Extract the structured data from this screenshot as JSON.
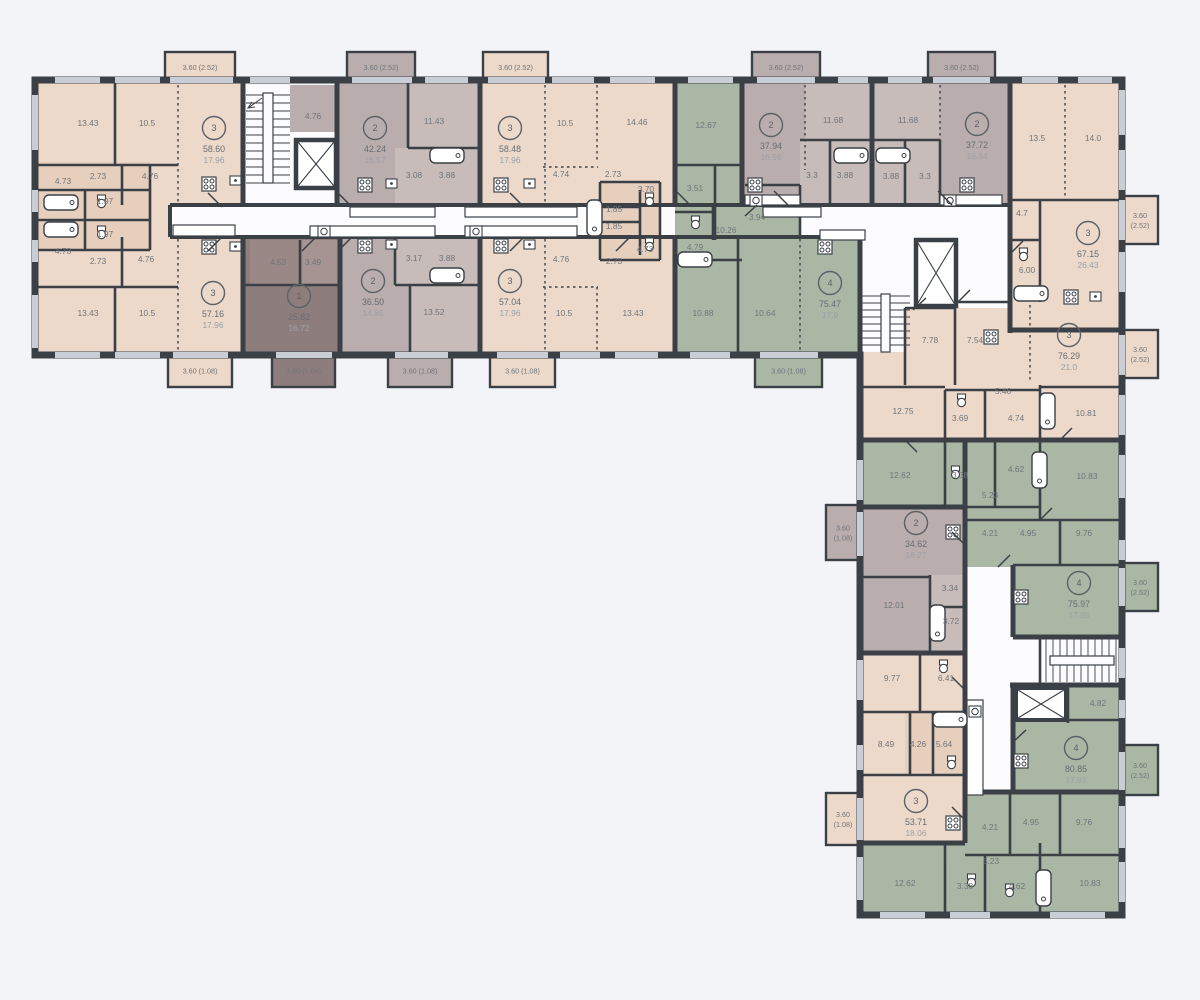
{
  "colors": {
    "wall": "#3B4046",
    "background": "#F3F4F8",
    "corridor": "#FCFCFE",
    "window": "#C9CED6",
    "beige": "#ECD9CA",
    "beige_dark": "#E7CFBE",
    "gray": "#B9ADAD",
    "gray_light": "#C7BCBA",
    "brown": "#8E7D7D",
    "brown_mid": "#9A8886",
    "brown_light": "#A69492",
    "green": "#AAB7A4",
    "text": "#70757C",
    "badge": "#5C6167"
  },
  "apartments": [
    {
      "number": "3",
      "total": "58.60",
      "living": "17.96",
      "cx": 214,
      "cy": 128
    },
    {
      "number": "2",
      "total": "42.24",
      "living": "16.57",
      "cx": 375,
      "cy": 128
    },
    {
      "number": "3",
      "total": "58.48",
      "living": "17.96",
      "cx": 510,
      "cy": 128
    },
    {
      "number": "2",
      "total": "37.94",
      "living": "16.56",
      "cx": 771,
      "cy": 125
    },
    {
      "number": "2",
      "total": "37.72",
      "living": "16.34",
      "cx": 977,
      "cy": 124
    },
    {
      "number": "3",
      "total": "67.15",
      "living": "26.43",
      "cx": 1088,
      "cy": 233
    },
    {
      "number": "4",
      "total": "75.47",
      "living": "17.9",
      "cx": 830,
      "cy": 283
    },
    {
      "number": "3",
      "total": "57.16",
      "living": "17.96",
      "cx": 213,
      "cy": 293
    },
    {
      "number": "1",
      "total": "25.82",
      "living": "16.72",
      "cx": 299,
      "cy": 296
    },
    {
      "number": "2",
      "total": "36.50",
      "living": "14.85",
      "cx": 373,
      "cy": 281
    },
    {
      "number": "3",
      "total": "57.04",
      "living": "17.96",
      "cx": 510,
      "cy": 281
    },
    {
      "number": "3",
      "total": "76.29",
      "living": "21.0",
      "cx": 1069,
      "cy": 335
    },
    {
      "number": "2",
      "total": "34.62",
      "living": "16.27",
      "cx": 916,
      "cy": 523
    },
    {
      "number": "4",
      "total": "75.97",
      "living": "17.85",
      "cx": 1079,
      "cy": 583
    },
    {
      "number": "3",
      "total": "53.71",
      "living": "18.06",
      "cx": 916,
      "cy": 801
    },
    {
      "number": "4",
      "total": "80.85",
      "living": "17.91",
      "cx": 1076,
      "cy": 748
    }
  ],
  "room_labels": [
    {
      "t": "13.43",
      "x": 88,
      "y": 126
    },
    {
      "t": "10.5",
      "x": 147,
      "y": 126
    },
    {
      "t": "2.73",
      "x": 98,
      "y": 179
    },
    {
      "t": "4.76",
      "x": 150,
      "y": 179
    },
    {
      "t": "4.73",
      "x": 63,
      "y": 184
    },
    {
      "t": "1.97",
      "x": 105,
      "y": 204
    },
    {
      "t": "1.97",
      "x": 105,
      "y": 237
    },
    {
      "t": "4.73",
      "x": 63,
      "y": 254
    },
    {
      "t": "2.73",
      "x": 98,
      "y": 264
    },
    {
      "t": "4.76",
      "x": 146,
      "y": 262
    },
    {
      "t": "13.43",
      "x": 88,
      "y": 316
    },
    {
      "t": "10.5",
      "x": 147,
      "y": 316
    },
    {
      "t": "4.76",
      "x": 313,
      "y": 119
    },
    {
      "t": "11.43",
      "x": 434,
      "y": 124
    },
    {
      "t": "3.08",
      "x": 414,
      "y": 178
    },
    {
      "t": "3.88",
      "x": 447,
      "y": 178
    },
    {
      "t": "10.5",
      "x": 565,
      "y": 126
    },
    {
      "t": "14.46",
      "x": 637,
      "y": 125
    },
    {
      "t": "4.74",
      "x": 561,
      "y": 177
    },
    {
      "t": "2.73",
      "x": 613,
      "y": 177
    },
    {
      "t": "3.70",
      "x": 646,
      "y": 192
    },
    {
      "t": "1.85",
      "x": 614,
      "y": 212
    },
    {
      "t": "1.85",
      "x": 614,
      "y": 229
    },
    {
      "t": "4.73",
      "x": 645,
      "y": 252
    },
    {
      "t": "2.73",
      "x": 614,
      "y": 264
    },
    {
      "t": "4.53",
      "x": 278,
      "y": 265
    },
    {
      "t": "3.49",
      "x": 313,
      "y": 265
    },
    {
      "t": "3.17",
      "x": 414,
      "y": 261
    },
    {
      "t": "3.88",
      "x": 447,
      "y": 261
    },
    {
      "t": "13.52",
      "x": 434,
      "y": 315
    },
    {
      "t": "4.76",
      "x": 561,
      "y": 262
    },
    {
      "t": "10.5",
      "x": 564,
      "y": 316
    },
    {
      "t": "13.43",
      "x": 633,
      "y": 316
    },
    {
      "t": "12.67",
      "x": 706,
      "y": 128
    },
    {
      "t": "3.51",
      "x": 695,
      "y": 191
    },
    {
      "t": "10.26",
      "x": 726,
      "y": 233
    },
    {
      "t": "4.79",
      "x": 695,
      "y": 250
    },
    {
      "t": "3.94",
      "x": 757,
      "y": 220
    },
    {
      "t": "10.88",
      "x": 703,
      "y": 316
    },
    {
      "t": "10.64",
      "x": 765,
      "y": 316
    },
    {
      "t": "11.68",
      "x": 833,
      "y": 123
    },
    {
      "t": "3.3",
      "x": 812,
      "y": 178
    },
    {
      "t": "3.88",
      "x": 845,
      "y": 178
    },
    {
      "t": "11.68",
      "x": 908,
      "y": 123
    },
    {
      "t": "3.88",
      "x": 891,
      "y": 179
    },
    {
      "t": "3.3",
      "x": 925,
      "y": 179
    },
    {
      "t": "13.5",
      "x": 1037,
      "y": 141
    },
    {
      "t": "14.0",
      "x": 1093,
      "y": 141
    },
    {
      "t": "4.7",
      "x": 1022,
      "y": 216
    },
    {
      "t": "6.00",
      "x": 1027,
      "y": 273
    },
    {
      "t": "7.78",
      "x": 930,
      "y": 343
    },
    {
      "t": "7.54",
      "x": 975,
      "y": 343
    },
    {
      "t": "5.46",
      "x": 1003,
      "y": 394
    },
    {
      "t": "12.75",
      "x": 903,
      "y": 414
    },
    {
      "t": "3.69",
      "x": 960,
      "y": 421
    },
    {
      "t": "4.74",
      "x": 1016,
      "y": 421
    },
    {
      "t": "10.81",
      "x": 1086,
      "y": 416
    },
    {
      "t": "12.62",
      "x": 900,
      "y": 478
    },
    {
      "t": "3.38",
      "x": 960,
      "y": 478
    },
    {
      "t": "4.62",
      "x": 1016,
      "y": 472
    },
    {
      "t": "10.83",
      "x": 1087,
      "y": 479
    },
    {
      "t": "5.23",
      "x": 990,
      "y": 498
    },
    {
      "t": "4.21",
      "x": 990,
      "y": 536
    },
    {
      "t": "4.95",
      "x": 1028,
      "y": 536
    },
    {
      "t": "9.76",
      "x": 1084,
      "y": 536
    },
    {
      "t": "3.34",
      "x": 950,
      "y": 591
    },
    {
      "t": "12.01",
      "x": 894,
      "y": 608
    },
    {
      "t": "3.72",
      "x": 951,
      "y": 624
    },
    {
      "t": "9.77",
      "x": 892,
      "y": 681
    },
    {
      "t": "6.41",
      "x": 946,
      "y": 681
    },
    {
      "t": "8.49",
      "x": 886,
      "y": 747
    },
    {
      "t": "4.26",
      "x": 918,
      "y": 747
    },
    {
      "t": "5.64",
      "x": 944,
      "y": 747
    },
    {
      "t": "4.82",
      "x": 1098,
      "y": 706
    },
    {
      "t": "4.21",
      "x": 990,
      "y": 830
    },
    {
      "t": "4.95",
      "x": 1031,
      "y": 825
    },
    {
      "t": "9.76",
      "x": 1084,
      "y": 825
    },
    {
      "t": "5.23",
      "x": 991,
      "y": 864
    },
    {
      "t": "12.62",
      "x": 905,
      "y": 886
    },
    {
      "t": "3.38",
      "x": 965,
      "y": 889
    },
    {
      "t": "4.62",
      "x": 1017,
      "y": 889
    },
    {
      "t": "10.83",
      "x": 1090,
      "y": 886
    }
  ],
  "balconies": [
    {
      "lines": [
        "3.60 (2.52)"
      ],
      "x": 165,
      "y": 52,
      "w": 70,
      "h": 31,
      "color": "beige"
    },
    {
      "lines": [
        "3.60 (2.52)"
      ],
      "x": 347,
      "y": 52,
      "w": 68,
      "h": 31,
      "color": "gray"
    },
    {
      "lines": [
        "3.60 (2.52)"
      ],
      "x": 483,
      "y": 52,
      "w": 65,
      "h": 31,
      "color": "beige"
    },
    {
      "lines": [
        "3.60 (2.52)"
      ],
      "x": 752,
      "y": 52,
      "w": 68,
      "h": 31,
      "color": "gray"
    },
    {
      "lines": [
        "3.60 (2.52)"
      ],
      "x": 928,
      "y": 52,
      "w": 67,
      "h": 31,
      "color": "gray"
    },
    {
      "lines": [
        "3.60 (1.08)"
      ],
      "x": 168,
      "y": 355,
      "w": 64,
      "h": 32,
      "color": "beige"
    },
    {
      "lines": [
        "3.60 (1.08)"
      ],
      "x": 272,
      "y": 355,
      "w": 63,
      "h": 32,
      "color": "brown"
    },
    {
      "lines": [
        "3.60 (1.08)"
      ],
      "x": 388,
      "y": 355,
      "w": 64,
      "h": 32,
      "color": "gray"
    },
    {
      "lines": [
        "3.60 (1.08)"
      ],
      "x": 490,
      "y": 355,
      "w": 65,
      "h": 32,
      "color": "beige"
    },
    {
      "lines": [
        "3.60 (1.08)"
      ],
      "x": 755,
      "y": 355,
      "w": 67,
      "h": 32,
      "color": "green"
    },
    {
      "lines": [
        "3.60",
        "(2.52)"
      ],
      "x": 1122,
      "y": 196,
      "w": 36,
      "h": 48,
      "color": "beige"
    },
    {
      "lines": [
        "3.60",
        "(2.52)"
      ],
      "x": 1122,
      "y": 330,
      "w": 36,
      "h": 48,
      "color": "beige"
    },
    {
      "lines": [
        "3.60",
        "(2.52)"
      ],
      "x": 1122,
      "y": 563,
      "w": 36,
      "h": 48,
      "color": "green"
    },
    {
      "lines": [
        "3.60",
        "(2.52)"
      ],
      "x": 1122,
      "y": 745,
      "w": 36,
      "h": 50,
      "color": "green"
    },
    {
      "lines": [
        "3.60",
        "(1.08)"
      ],
      "x": 826,
      "y": 505,
      "w": 34,
      "h": 55,
      "color": "gray"
    },
    {
      "lines": [
        "3.60",
        "(1.08)"
      ],
      "x": 826,
      "y": 793,
      "w": 34,
      "h": 52,
      "color": "beige"
    }
  ]
}
